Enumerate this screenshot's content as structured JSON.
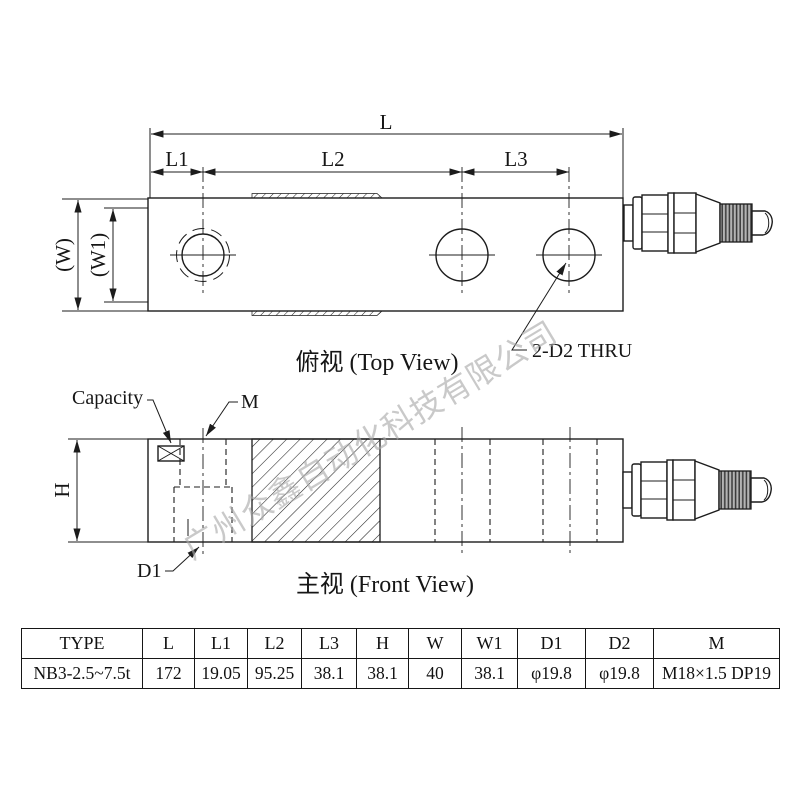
{
  "drawing": {
    "top_view": {
      "title": "俯视 (Top View)",
      "labels": {
        "L": "L",
        "L1": "L1",
        "L2": "L2",
        "L3": "L3",
        "W": "(W)",
        "W1": "(W1)"
      },
      "hole_note": "2-D2 THRU"
    },
    "front_view": {
      "title": "主视 (Front View)",
      "labels": {
        "capacity": "Capacity",
        "M": "M",
        "H": "H",
        "D1": "D1"
      }
    },
    "watermark": "广州众鑫自动化科技有限公司"
  },
  "table": {
    "headers": [
      "TYPE",
      "L",
      "L1",
      "L2",
      "L3",
      "H",
      "W",
      "W1",
      "D1",
      "D2",
      "M"
    ],
    "rows": [
      [
        "NB3-2.5~7.5t",
        "172",
        "19.05",
        "95.25",
        "38.1",
        "38.1",
        "40",
        "38.1",
        "φ19.8",
        "φ19.8",
        "M18×1.5 DP19"
      ]
    ]
  },
  "colors": {
    "line": "#1c1c1c",
    "watermark": "#a9a9a9"
  }
}
